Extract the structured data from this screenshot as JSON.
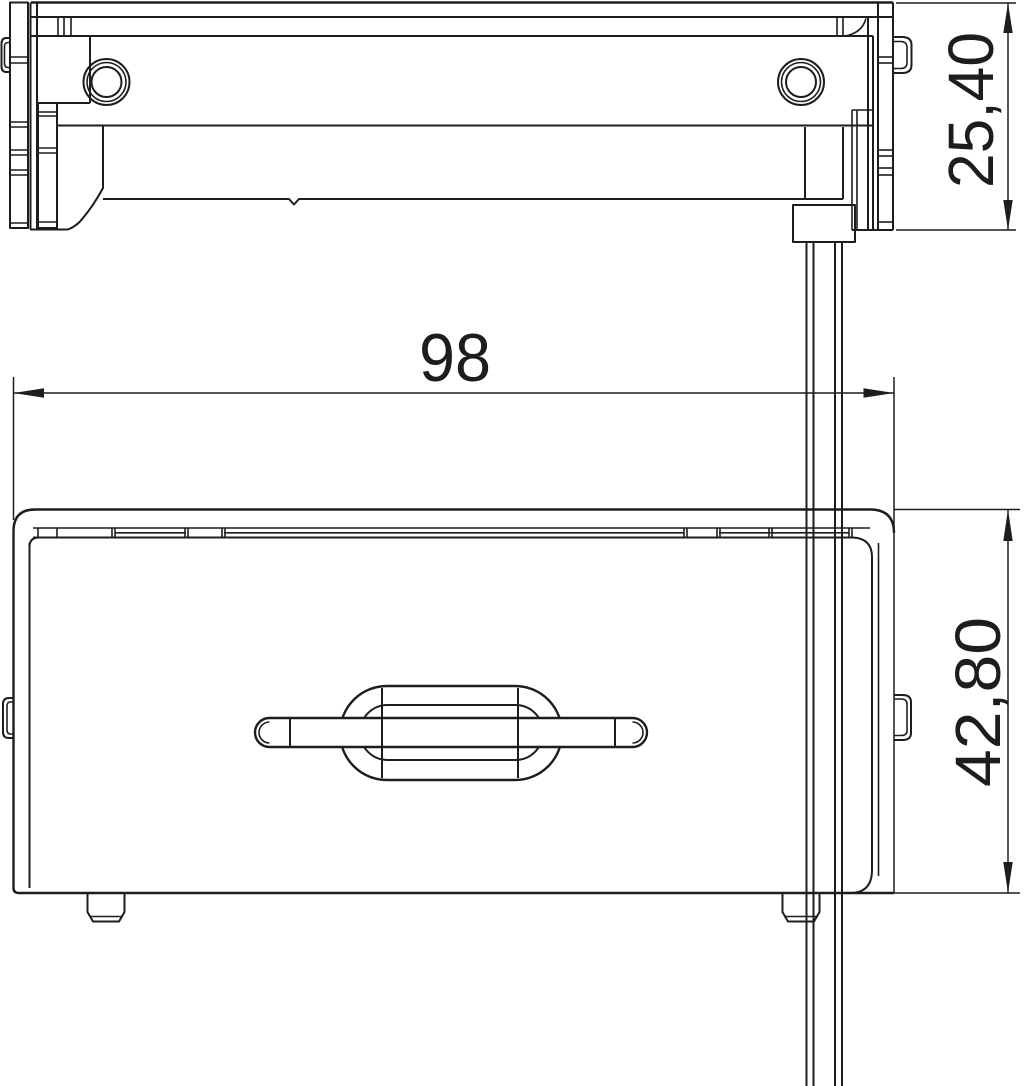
{
  "drawing": {
    "kind": "technical-dimension-drawing",
    "background_color": "#ffffff",
    "line_color": "#1d1d1b",
    "views": {
      "top_view": "device seen from above with two screws and cable clamp",
      "front_view": "device body with rotary handle, side tabs and feet"
    },
    "dimensions": {
      "overall_width": {
        "label": "98",
        "orientation": "horizontal"
      },
      "top_view_height": {
        "label": "25,40",
        "orientation": "vertical"
      },
      "front_view_height": {
        "label": "42,80",
        "orientation": "vertical"
      }
    }
  }
}
